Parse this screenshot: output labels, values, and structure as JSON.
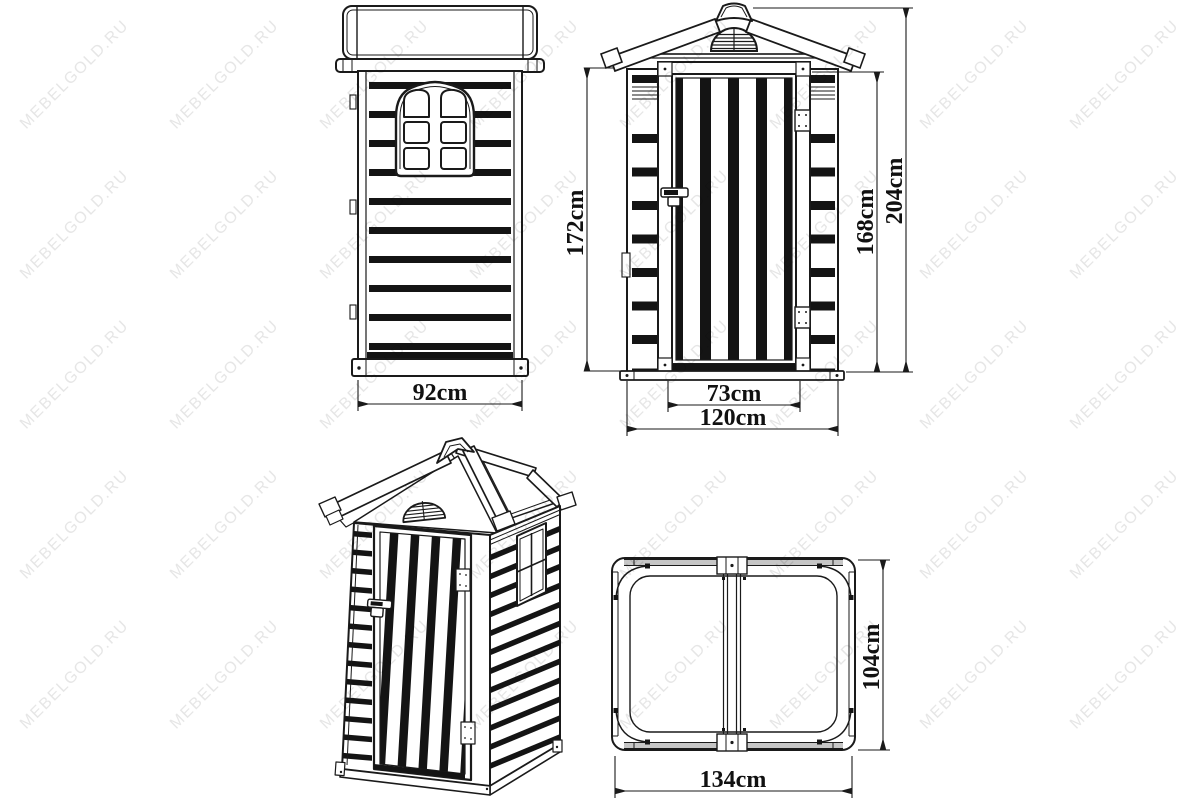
{
  "watermark": {
    "text": "MEBELGOLD.RU",
    "color": "#e6e6e6"
  },
  "drawing": {
    "ink": "#1a1a1a",
    "slat_fill": "#141414",
    "background": "#ffffff",
    "metal_band": "#c6c6c6"
  },
  "views": {
    "side_elevation": {
      "width": "92cm",
      "height": "172cm"
    },
    "front_elevation": {
      "door_width": "73cm",
      "overall_width": "120cm",
      "door_height": "168cm",
      "overall_height": "204cm"
    },
    "plan": {
      "width": "134cm",
      "depth": "104cm"
    }
  }
}
